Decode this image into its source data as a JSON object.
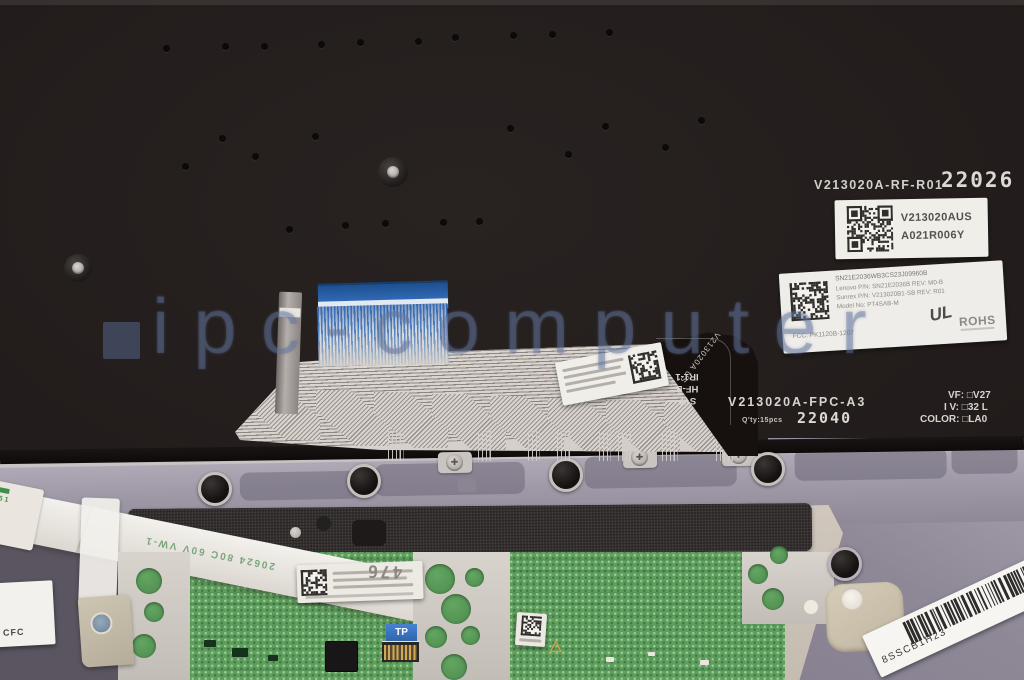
{
  "watermark": {
    "text": "ipc-computer"
  },
  "plate": {
    "part_print": "V213020A-RF-R01",
    "date_stamp": "22026"
  },
  "qr_label": {
    "part": "V213020AUS",
    "rev": "A021R006Y"
  },
  "spec_label": {
    "serial": "SN21E2036WB3CS23J09960B",
    "line_oem": "Lenovo P/N: SN21E2036B    REV: M0-B",
    "line_vendor": "Sunrex P/N: V213020B1-SB  REV: R01",
    "line_model": "Model No: PT4SAB-M",
    "line_fcc": "FCC: PK1120B-1207",
    "ul_mark": "UL",
    "rohs_mark": "ROHS"
  },
  "fpc": {
    "part_print": "V213020A-FPC-A3",
    "qty_print": "Q'ty:15pcs",
    "date_stamp": "22040",
    "opt_vf": "VF: □V27",
    "opt_iv": "I V: □32 L",
    "opt_color": "COLOR: □LA0",
    "mark_line1": "SYF",
    "mark_line2": "HF-B",
    "mark_line3": "IR1-1",
    "diagonal_mark": "V213020A US"
  },
  "ffc": {
    "print": "20624 80C 60V VW-1",
    "end_mark": "26 1"
  },
  "touchpad": {
    "tab_label": "TP",
    "stamp": "476"
  },
  "corner_label": {
    "text": "CFC"
  },
  "barcode_label": {
    "text": "8SSCB1H23"
  },
  "colors": {
    "cable_blue": "#3b79cc",
    "pcb_green": "#5f9f5e",
    "watermark": "#6074a0",
    "plate": "#1f1a19",
    "band_gray": "#9e98a6",
    "deck_beige": "#cfc6ba"
  }
}
